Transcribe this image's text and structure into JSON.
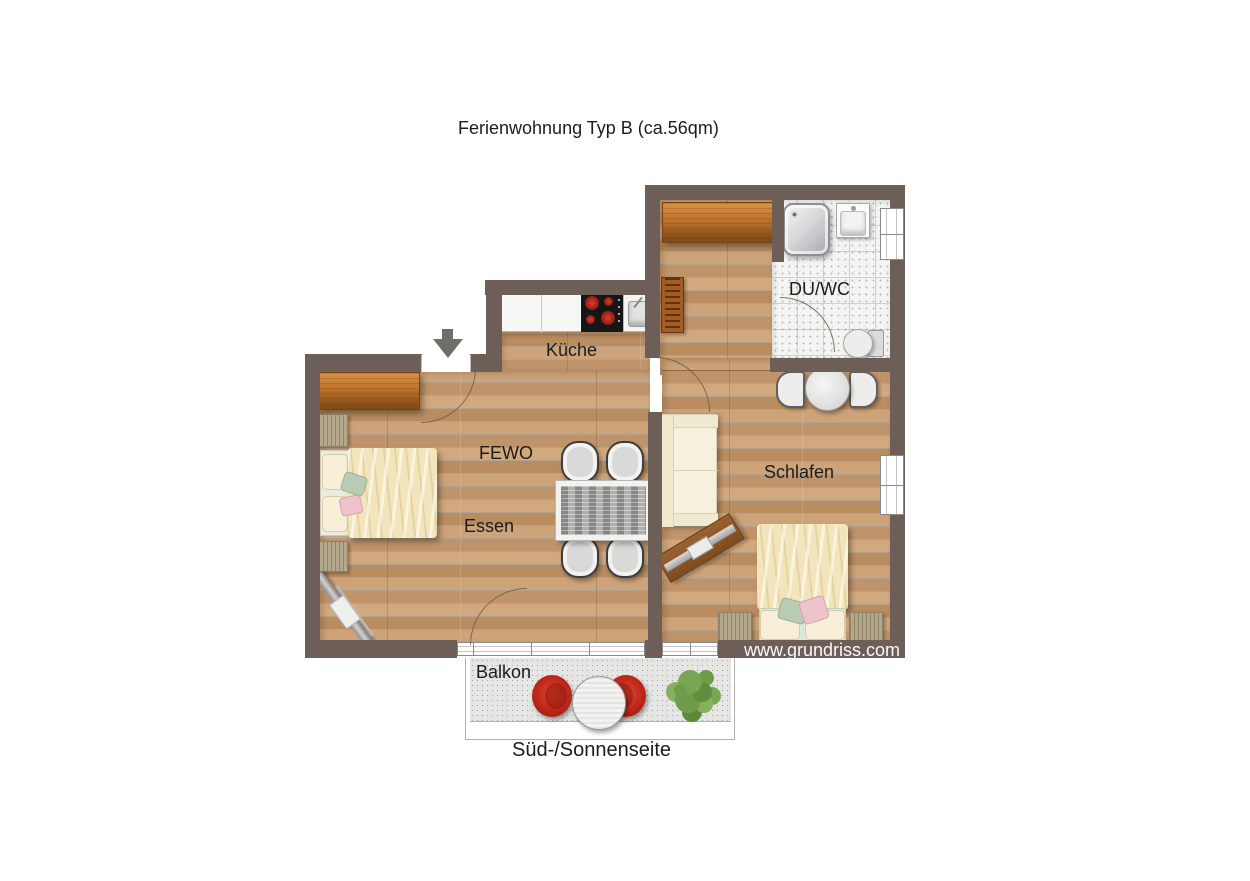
{
  "title": "Ferienwohnung Typ B (ca.56qm)",
  "caption": "Süd-/Sonnenseite",
  "watermark": "www.grundriss.com",
  "labels": {
    "kitchen": "Küche",
    "bathroom": "DU/WC",
    "living": "FEWO",
    "dining": "Essen",
    "bedroom": "Schlafen",
    "balcony": "Balkon"
  },
  "colors": {
    "wall": "#6d5e58",
    "wood_floor": "#c69b6e",
    "tile_floor": "#f4f4f2",
    "balcony_floor": "#e6e6e4",
    "wardrobe_wood": "#c1762c",
    "bed_linen": "#f3e5bb",
    "accent_pillow_green": "#b9cbb2",
    "accent_pillow_pink": "#eec3cb",
    "balcony_chair_red": "#c1291b",
    "plant_green": "#79a553",
    "dining_table_top": "#a2a2a0",
    "label_text": "#1c1c1c"
  }
}
